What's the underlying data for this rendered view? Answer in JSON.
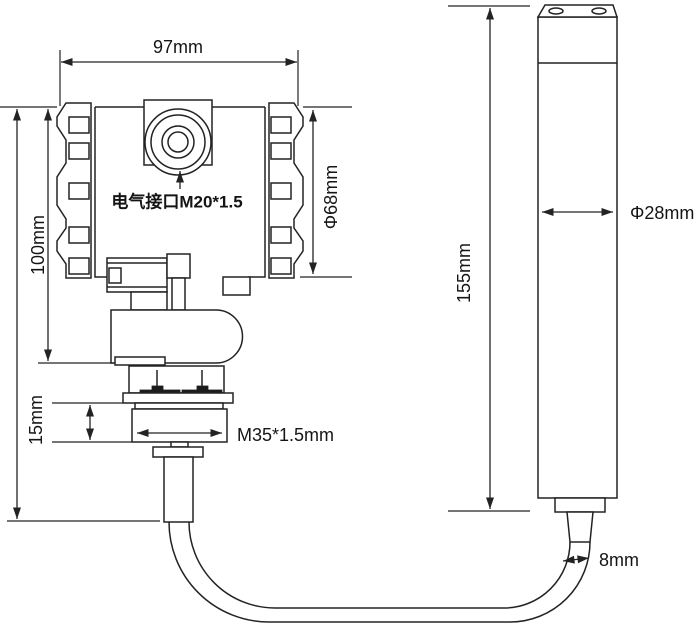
{
  "drawing": {
    "description": "Dimensional outline drawing of a pressure/level transmitter with round terminal housing, M35 process thread, and a cable-connected submersible probe",
    "background_color": "#ffffff",
    "line_color": "#232323",
    "text_color": "#141414",
    "transmitter": {
      "dim_width": "97mm",
      "dim_height": "100mm",
      "dim_nut_height": "15mm",
      "dim_housing_diameter": "Φ68mm",
      "label_electrical_port": "电气接口M20*1.5",
      "label_process_thread": "M35*1.5mm"
    },
    "probe": {
      "dim_length": "155mm",
      "dim_diameter": "Φ28mm",
      "dim_cable_diameter": "8mm"
    }
  }
}
